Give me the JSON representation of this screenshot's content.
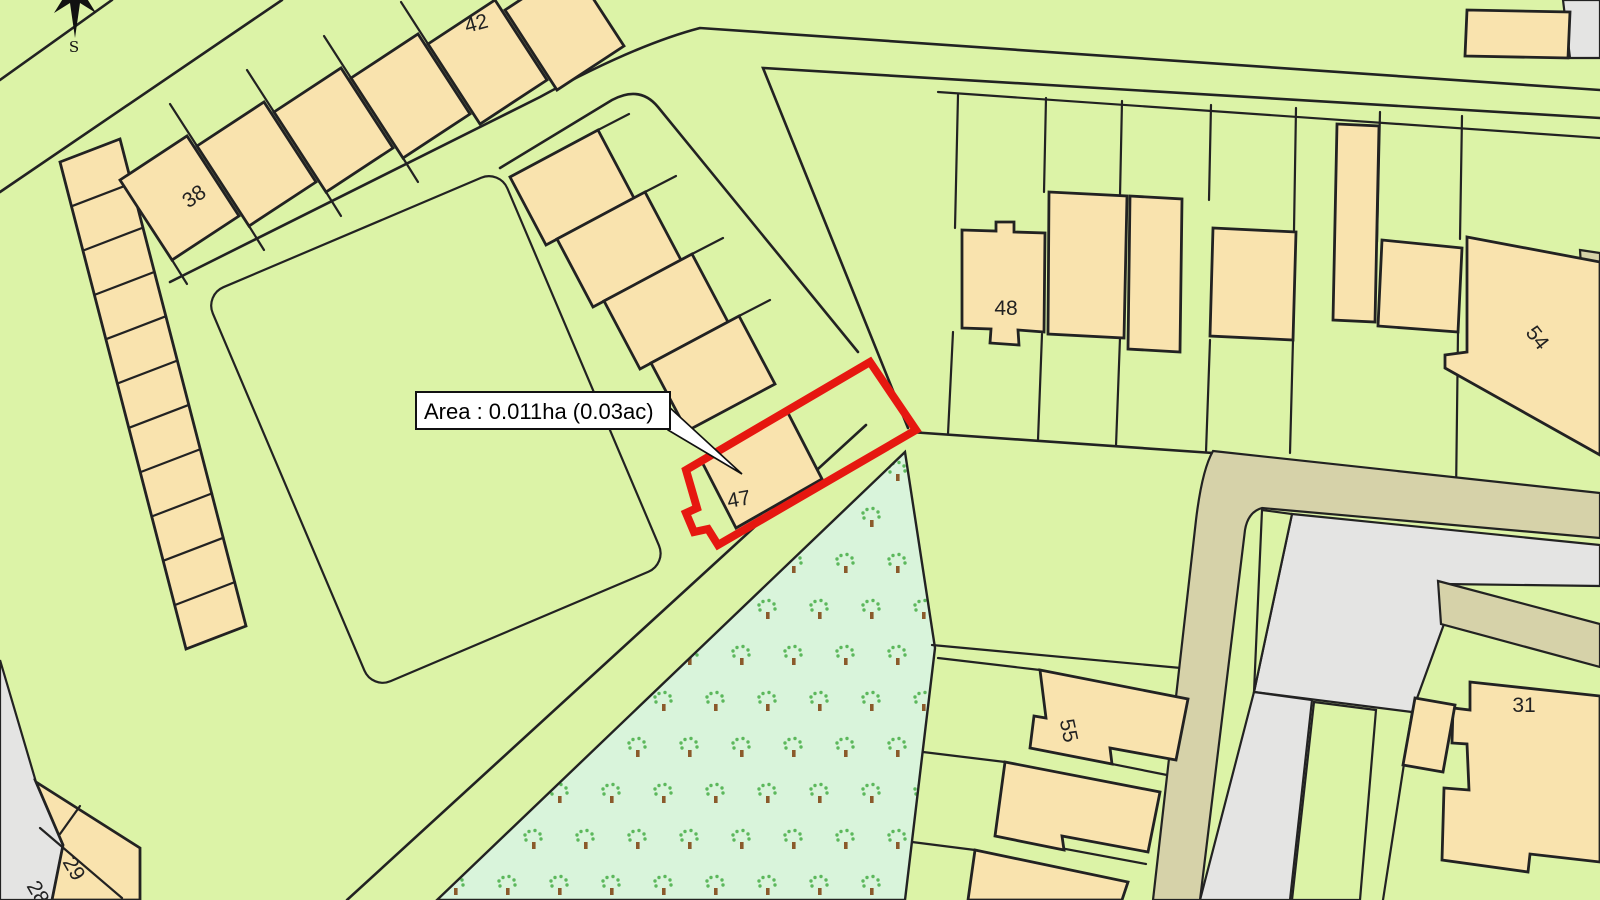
{
  "map": {
    "area_annotation": {
      "text": "Area : 0.011ha (0.03ac)"
    },
    "compass_label": "S",
    "plot_numbers": {
      "n42": "42",
      "n38": "38",
      "n47": "47",
      "n48": "48",
      "n54": "54",
      "n55": "55",
      "n31": "31",
      "n29": "29",
      "n28": "28"
    },
    "colors": {
      "parcel_green": "#DCF3A7",
      "orchard_green": "#D9F4DB",
      "building_tan": "#F9E3AE",
      "path_khaki": "#D6D2A9",
      "unregistered_gray": "#E4E4E3",
      "selection_red": "#E61710",
      "line_black": "#222222",
      "tree_foliage": "#5CB85C",
      "tree_trunk": "#8B5A2B"
    }
  }
}
